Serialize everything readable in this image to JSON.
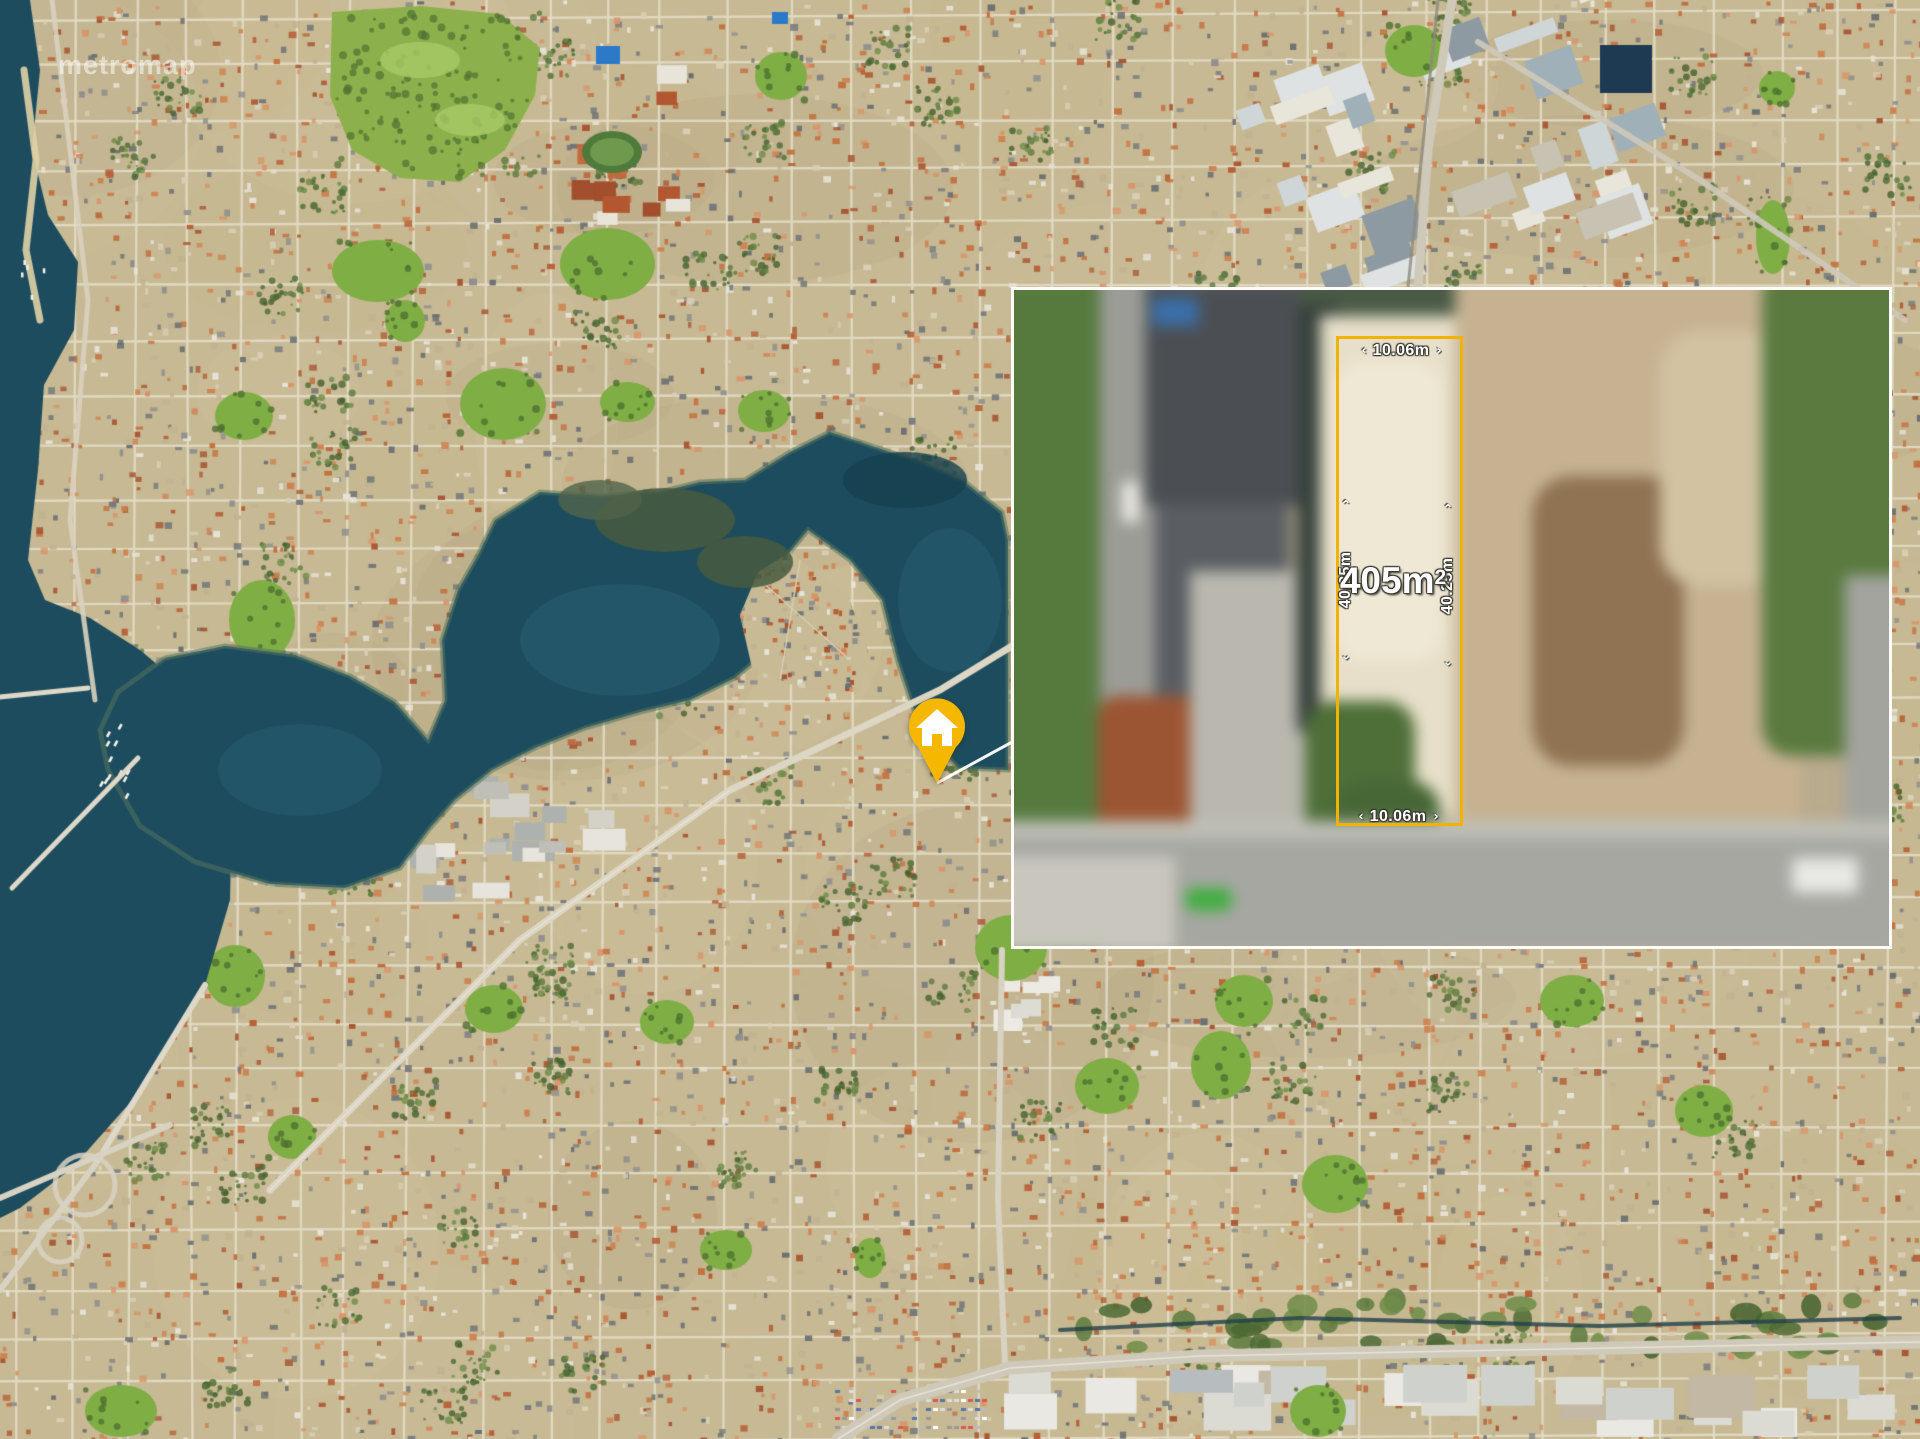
{
  "watermark": {
    "text": "metromap"
  },
  "inset": {
    "area_value": "405m",
    "area_superscript": "2",
    "dim_top": "10.06m",
    "dim_bottom": "10.06m",
    "dim_left": "40.25m",
    "dim_right": "40.25m"
  },
  "icons": {
    "house": "house-icon",
    "dim_arrow_up": "⌃",
    "dim_arrow_down": "⌄",
    "dim_arrow_left": "‹",
    "dim_arrow_right": "›"
  },
  "colors": {
    "accent_yellow": "#F2B300",
    "pin_yellow": "#F5B700",
    "inset_border": "#FFFFFF",
    "label_text": "#FFFFFF",
    "water": "#1D4C5E",
    "park_green": "#7FAE45"
  }
}
